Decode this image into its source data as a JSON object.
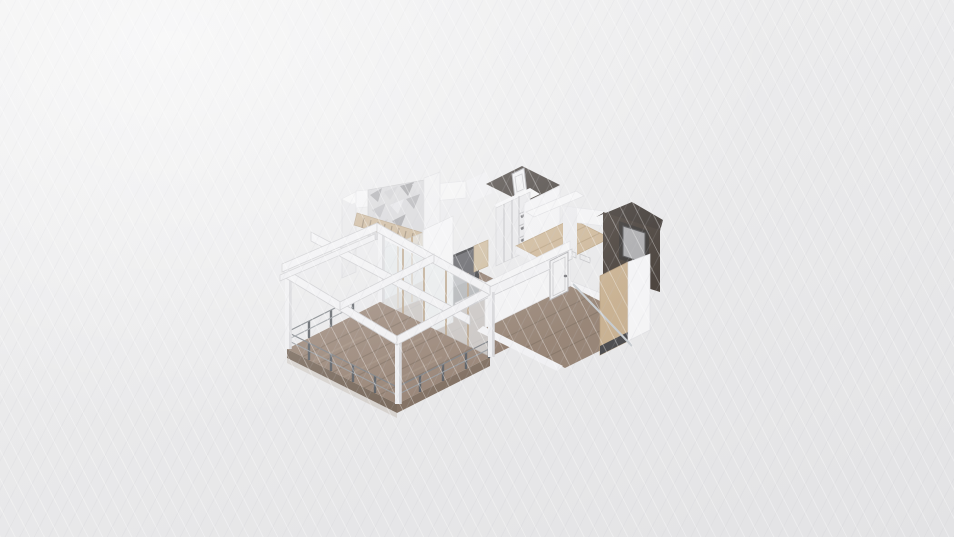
{
  "scene": {
    "viewport": {
      "width": 954,
      "height": 537,
      "background": "#ebebec"
    },
    "palette": {
      "background": "#ebebec",
      "white_wall_lit": "#f8f8f9",
      "white_wall_shade": "#e6e6e8",
      "deck_wood": "#8a7260",
      "interior_wood": "#7e6654",
      "light_wood": "#c9ae88",
      "dark_wall": "#241c16",
      "glass": "#e6eaec",
      "wood_mullion": "#b29878",
      "railing_post": "#3f444a",
      "tv_black": "#1a1a1d",
      "panel_gray": "#a2a2a4"
    },
    "elements": [
      {
        "n": "wall-back-left-face",
        "t": "poly",
        "pts": "342,199 356,192 356,272 342,278",
        "f": "#e6e6e8",
        "s": "#d4d4d7",
        "w": 0.7,
        "i": false
      },
      {
        "n": "wall-back-left-top",
        "t": "poly",
        "pts": "342,199 356,192 366,197 352,204",
        "f": "#f8f8f9",
        "i": false
      },
      {
        "n": "wall-back-band",
        "t": "poly",
        "pts": "356,191 466,181 466,198 356,208",
        "f": "#f6f6f7",
        "s": "#e0e0e3",
        "w": 0.7,
        "i": false
      },
      {
        "n": "bathroom-wall-left-band",
        "t": "poly",
        "pts": "466,181 486,172 492,193 472,202",
        "f": "#f1f1f3",
        "i": false
      },
      {
        "n": "accent-wall-mosaic",
        "t": "poly",
        "pts": "368,190 424,180 424,231 368,241",
        "f": "#d2d2d5",
        "s": "#bfbfc2",
        "w": 0.7,
        "i": false
      },
      {
        "n": "mosaic-tile",
        "t": "poly",
        "pts": "370,195 382,188 378,202",
        "f": "#9a9a9e",
        "i": false
      },
      {
        "n": "mosaic-tile",
        "t": "poly",
        "pts": "384,192 398,186 390,200",
        "f": "#c7c7ca",
        "i": false
      },
      {
        "n": "mosaic-tile",
        "t": "poly",
        "pts": "400,186 414,182 408,196",
        "f": "#8e8e92",
        "i": false
      },
      {
        "n": "mosaic-tile",
        "t": "poly",
        "pts": "412,184 422,182 418,194",
        "f": "#d6d6d9",
        "i": false
      },
      {
        "n": "mosaic-tile",
        "t": "poly",
        "pts": "372,210 386,203 380,218",
        "f": "#b3b3b7",
        "i": false
      },
      {
        "n": "mosaic-tile",
        "t": "poly",
        "pts": "390,205 404,199 398,214",
        "f": "#e3e3e6",
        "i": false
      },
      {
        "n": "mosaic-tile",
        "t": "poly",
        "pts": "406,199 420,194 414,209",
        "f": "#a3a3a7",
        "i": false
      },
      {
        "n": "mosaic-tile",
        "t": "poly",
        "pts": "374,226 388,219 382,234",
        "f": "#c0c0c3",
        "i": false
      },
      {
        "n": "mosaic-tile",
        "t": "poly",
        "pts": "392,221 406,214 400,229",
        "f": "#929296",
        "i": false
      },
      {
        "n": "staircase",
        "t": "poly",
        "pts": "357,213 433,236 430,248 354,225",
        "f": "#c3a984",
        "s": "#a98f6c",
        "w": 0.7,
        "i": true
      },
      {
        "n": "staircase-steps",
        "t": "path",
        "d": "M364,218 L362,228 M371,220 L369,230 M378,222 L376,232 M385,224 L383,234 M392,226 L390,236 M399,228 L397,238 M406,231 L404,241 M413,233 L411,243 M420,235 L418,245 M427,237 L425,247",
        "s": "#8a7356",
        "w": 1.2,
        "i": false
      },
      {
        "n": "wall-pillar",
        "t": "poly",
        "pts": "424,178 440,172 440,230 424,236",
        "f": "#f0f0f2",
        "s": "#dcdcdf",
        "w": 0.7,
        "i": false
      },
      {
        "n": "bathroom-dark-walls",
        "t": "poly",
        "pts": "486,184 522,166 560,185 524,203",
        "f": "#241c16",
        "i": false
      },
      {
        "n": "bathroom-door",
        "t": "poly",
        "pts": "512,174 524,168 527,193 515,199",
        "f": "#f2f2f3",
        "s": "#9a9a9e",
        "w": 1,
        "i": true
      },
      {
        "n": "bathroom-door-panel",
        "t": "path",
        "d": "M515,177 L522,174 L524,189 L517,192 Z",
        "s": "#c0c0c3",
        "w": 0.8,
        "i": false
      },
      {
        "n": "wardrobe-top-band",
        "t": "poly",
        "pts": "494,205 530,188 540,194 504,211",
        "f": "#f8f8f9",
        "i": false
      },
      {
        "n": "wardrobe",
        "t": "poly",
        "pts": "496,208 530,192 530,250 496,266",
        "f": "#e9e9eb",
        "s": "#cfcfd2",
        "w": 0.7,
        "i": true
      },
      {
        "n": "wardrobe-doors-shelves",
        "t": "path",
        "d": "M504,204 L504,262 M512,200 L512,258 M519,196 L519,254 M519,214 L530,209 M519,226 L530,221 M519,238 L530,233",
        "s": "#b4b4b8",
        "w": 1,
        "i": false
      },
      {
        "n": "wardrobe-shelf-items",
        "t": "path",
        "d": "M521,217 L529,213 M521,229 L529,225 M521,241 L529,237",
        "s": "#55555a",
        "w": 2.5,
        "i": false
      },
      {
        "n": "hall-back-wall",
        "t": "poly",
        "pts": "524,203 560,186 560,236 524,253",
        "f": "#f5f5f7",
        "s": "#e2e2e5",
        "w": 0.7,
        "i": false
      },
      {
        "n": "hall-console-shelf",
        "t": "poly",
        "pts": "526,212 576,191 584,196 534,217",
        "f": "#f9f9fa",
        "s": "#dddde0",
        "w": 0.7,
        "i": true
      },
      {
        "n": "hall-floor",
        "t": "poly",
        "pts": "516,246 572,219 610,238 554,266",
        "f": "#c9ae88",
        "s": "#b3976f",
        "w": 0.7,
        "i": false
      },
      {
        "n": "hall-floor-planks",
        "t": "path",
        "d": "M530,253 L586,226 M544,260 L600,233",
        "s": "#b3976f",
        "w": 1,
        "i": false
      },
      {
        "n": "hall-fascia",
        "t": "poly",
        "pts": "516,246 554,266 554,273 516,253",
        "f": "#efeff1",
        "i": false
      },
      {
        "n": "hall-white-band",
        "t": "poly",
        "pts": "563,206 604,211 604,226 563,221",
        "f": "#f7f7f8",
        "s": "#e3e3e6",
        "w": 0.7,
        "i": false
      },
      {
        "n": "hall-corner-wall",
        "t": "poly",
        "pts": "563,206 577,208 577,257 563,255",
        "f": "#ededef",
        "i": false
      },
      {
        "n": "mediaroom-dark-top",
        "t": "poly",
        "pts": "596,217 632,202 663,220 660,231 603,213",
        "f": "#1f1711",
        "i": false
      },
      {
        "n": "mediaroom-dark-wall",
        "t": "poly",
        "pts": "603,212 660,230 660,292 603,274",
        "f": "#281e16",
        "i": false
      },
      {
        "n": "wall-panel-frame",
        "t": "poly",
        "pts": "619,221 649,231 649,269 619,259",
        "f": "#171310",
        "i": false
      },
      {
        "n": "wall-panel",
        "t": "poly",
        "pts": "623,226 645,233 645,263 623,256",
        "f": "#a2a2a4",
        "s": "#3a3a3c",
        "w": 1,
        "i": true
      },
      {
        "n": "bedroom-ne-wall-band",
        "t": "poly",
        "pts": "556,275 638,308 638,318 556,285",
        "f": "#f6f6f8",
        "s": "#e0e0e3",
        "w": 0.7,
        "i": false
      },
      {
        "n": "wall-vents",
        "t": "path",
        "d": "M566,249 L576,253 L576,258 L566,254 Z M580,254 L590,258 L590,263 L580,259 Z",
        "s": "#bfbfc2",
        "w": 0.8,
        "i": false
      },
      {
        "n": "livingroom-floor",
        "t": "poly",
        "pts": "380,302 460,262 570,317 490,357",
        "f": "#7e6654",
        "i": false
      },
      {
        "n": "livingroom-floor-planks",
        "t": "path",
        "d": "M402,313 L482,273 M424,324 L504,284 M446,335 L526,295 M468,346 L548,306",
        "s": "#6a5443",
        "w": 1,
        "i": false
      },
      {
        "n": "tv-panel",
        "t": "poly",
        "pts": "448,257 479,244 479,300 448,313",
        "f": "#1a1a1d",
        "i": true
      },
      {
        "n": "tv-screen",
        "t": "poly",
        "pts": "452,258 475,248 475,278 452,288",
        "f": "#46464b",
        "i": false
      },
      {
        "n": "tan-cabinet",
        "t": "poly",
        "pts": "474,246 488,240 488,266 474,272",
        "f": "#cbb591",
        "s": "#b29a74",
        "w": 0.7,
        "i": true
      },
      {
        "n": "glass-partition",
        "t": "poly",
        "pts": "384,248 440,226 440,292 384,314",
        "f": "#e9edef",
        "o": 0.65,
        "s": "#c6cbcf",
        "w": 0.7,
        "i": true
      },
      {
        "n": "glass-partition-mullions",
        "t": "path",
        "d": "M398,243 L398,308 M412,237 L412,302 M426,232 L426,297",
        "s": "#b8996f",
        "w": 2,
        "i": false
      },
      {
        "n": "livingroom-front-wall",
        "t": "poly",
        "pts": "423,230 453,216 453,322 423,336",
        "f": "#f8f8f9",
        "s": "#dcdcdf",
        "w": 0.7,
        "i": false
      },
      {
        "n": "sliding-glass-wall",
        "t": "poly",
        "pts": "381,303 489,356 489,284 381,231",
        "f": "#e6eaec",
        "o": 0.7,
        "s": "#c6cbcf",
        "w": 0.7,
        "i": true
      },
      {
        "n": "sliding-glass-mullions",
        "t": "path",
        "d": "M403,314 L403,241 M424,324 L424,251 M446,335 L446,262 M468,346 L468,273",
        "s": "#b29878",
        "w": 1.8,
        "i": false
      },
      {
        "n": "glass-header-band",
        "t": "poly",
        "pts": "381,231 489,284 489,291 381,238",
        "f": "#f5f5f7",
        "i": false
      },
      {
        "n": "bedroom-floor",
        "t": "poly",
        "pts": "485,328 570,286 650,326 565,368",
        "f": "#87705d",
        "i": false
      },
      {
        "n": "bedroom-floor-planks",
        "t": "path",
        "d": "M505,338 L590,296 M525,348 L610,306 M545,358 L630,316",
        "s": "#74604e",
        "w": 1,
        "i": false
      },
      {
        "n": "bedroom-nw-wall",
        "t": "poly",
        "pts": "485,328 570,286 570,241 485,283",
        "f": "#f7f7f8",
        "s": "#e0e0e3",
        "w": 0.7,
        "i": false
      },
      {
        "n": "bedroom-wall-top-beam",
        "t": "poly",
        "pts": "455,303 572,249 572,259 455,313",
        "f": "#f4f4f6",
        "s": "#c7c7ca",
        "w": 0.8,
        "i": false
      },
      {
        "n": "bedroom-door",
        "t": "poly",
        "pts": "550,300 568,291 568,252 550,261",
        "f": "#f4f4f5",
        "s": "#a9a9ac",
        "w": 1,
        "i": true
      },
      {
        "n": "bedroom-door-panel",
        "t": "path",
        "d": "M553,296 L565,290 L565,257 L553,263 Z",
        "s": "#c2c2c5",
        "w": 0.8,
        "i": false
      },
      {
        "n": "bedroom-door-knob",
        "t": "path",
        "d": "M565,276 L566,276",
        "s": "#606065",
        "w": 2.5,
        "cap": "round",
        "i": false
      },
      {
        "n": "bedroom-sw-band",
        "t": "poly",
        "pts": "483,326 563,366 557,371 477,331",
        "f": "#f6f6f8",
        "i": false
      },
      {
        "n": "bedroom-se-tan-wall",
        "t": "poly",
        "pts": "600,355 628,341 628,262 600,276",
        "f": "#c4a77f",
        "s": "#ab8d66",
        "w": 0.7,
        "i": false
      },
      {
        "n": "bedroom-se-wall-base",
        "t": "poly",
        "pts": "600,355 628,341 628,332 600,346",
        "f": "#2b2b2d",
        "i": false
      },
      {
        "n": "bedroom-se-white-wall",
        "t": "poly",
        "pts": "628,341 650,330 650,254 628,262",
        "f": "#fafafb",
        "s": "#e2e2e5",
        "w": 0.7,
        "i": false
      },
      {
        "n": "leaning-glass-pane",
        "t": "path",
        "d": "M575,286 L632,346 M573,284 L630,344",
        "s": "#c2c8cc",
        "w": 2,
        "i": true
      },
      {
        "n": "deck-floor",
        "t": "poly",
        "pts": "287,349 380,302 490,357 397,404",
        "f": "#8a7260",
        "i": false
      },
      {
        "n": "deck-planks",
        "t": "path",
        "d": "M302,357 L395,310 M318,364 L411,317 M333,372 L426,325 M349,380 L442,333 M364,388 L457,341 M379,395 L472,348",
        "s": "#75604e",
        "w": 1.2,
        "i": false
      },
      {
        "n": "deck-plank-streaks",
        "t": "path",
        "d": "M312,362 L362,337 M342,378 L422,338 M372,392 L442,357",
        "s": "#9a8470",
        "w": 2,
        "o": 0.6,
        "i": false
      },
      {
        "n": "deck-fascia-sw",
        "t": "poly",
        "pts": "287,349 397,404 397,413 287,358",
        "f": "#63503f",
        "i": false
      },
      {
        "n": "deck-fascia-se",
        "t": "poly",
        "pts": "397,404 490,357 490,366 397,413",
        "f": "#6d5846",
        "i": false
      },
      {
        "n": "deck-substep",
        "t": "poly",
        "pts": "287,358 397,413 397,418 287,363",
        "f": "#cfc9c2",
        "o": 0.8,
        "i": false
      },
      {
        "n": "railing-posts",
        "t": "path",
        "d": "M287,349 L287,332 M309,360 L309,343 M331,371 L331,354 M353,382 L353,365 M375,393 L375,376 M397,404 L397,387 M420,392 L420,375 M443,381 L443,364 M466,369 L466,352 M489,358 L489,341 M309,338 L309,321 M331,327 L331,310 M353,316 L353,299",
        "s": "#3f444a",
        "w": 2.4,
        "i": true
      },
      {
        "n": "railing-top-rail",
        "t": "path",
        "d": "M287,332 L397,387 L489,341 M287,332 L353,299",
        "s": "#6a6f74",
        "w": 1.2,
        "i": false
      },
      {
        "n": "railing-mid-rail",
        "t": "path",
        "d": "M287,340 L397,395 L489,349 M287,340 L353,307",
        "s": "#8a8f94",
        "w": 1,
        "i": false
      },
      {
        "n": "pergola-post-shadows",
        "t": "path",
        "d": "M289,349 L289,274 M399,404 L399,342 M492,357 L492,292 M382,302 L382,229",
        "s": "#d5d5d8",
        "w": 5.5,
        "i": false
      },
      {
        "n": "pergola-posts",
        "t": "path",
        "d": "M287,349 L287,273 M397,404 L397,341 M490,357 L490,291 M380,302 L380,228",
        "s": "#f2f2f4",
        "w": 4,
        "i": false
      },
      {
        "n": "pergola-beam-cross-long",
        "t": "poly",
        "pts": "311,232 470,316 470,325 311,241",
        "f": "#f4f4f6",
        "s": "#c7c7ca",
        "w": 0.8,
        "i": false
      },
      {
        "n": "pergola-beam-sw",
        "t": "poly",
        "pts": "284,268 397,336 397,345 284,277",
        "f": "#f4f4f6",
        "s": "#c7c7ca",
        "w": 0.8,
        "i": false
      },
      {
        "n": "pergola-beam-se",
        "t": "poly",
        "pts": "397,336 490,286 490,295 397,345",
        "f": "#f4f4f6",
        "s": "#c7c7ca",
        "w": 0.8,
        "i": false
      },
      {
        "n": "pergola-beam-nw",
        "t": "poly",
        "pts": "282,264 377,223 377,231 282,272",
        "f": "#f4f4f6",
        "s": "#c7c7ca",
        "w": 0.8,
        "i": false
      },
      {
        "n": "pergola-beam-nw-outer",
        "t": "poly",
        "pts": "280,275 375,234 375,240 280,281",
        "f": "#f1f1f3",
        "s": "#c7c7ca",
        "w": 0.7,
        "i": false
      },
      {
        "n": "pergola-beam-ne",
        "t": "poly",
        "pts": "377,223 490,286 490,295 377,232",
        "f": "#f4f4f6",
        "s": "#c7c7ca",
        "w": 0.8,
        "i": false
      },
      {
        "n": "pergola-beam-cross-mid",
        "t": "poly",
        "pts": "340,302 434,254 434,262 340,310",
        "f": "#f4f4f6",
        "s": "#c7c7ca",
        "w": 0.8,
        "i": false
      }
    ]
  }
}
